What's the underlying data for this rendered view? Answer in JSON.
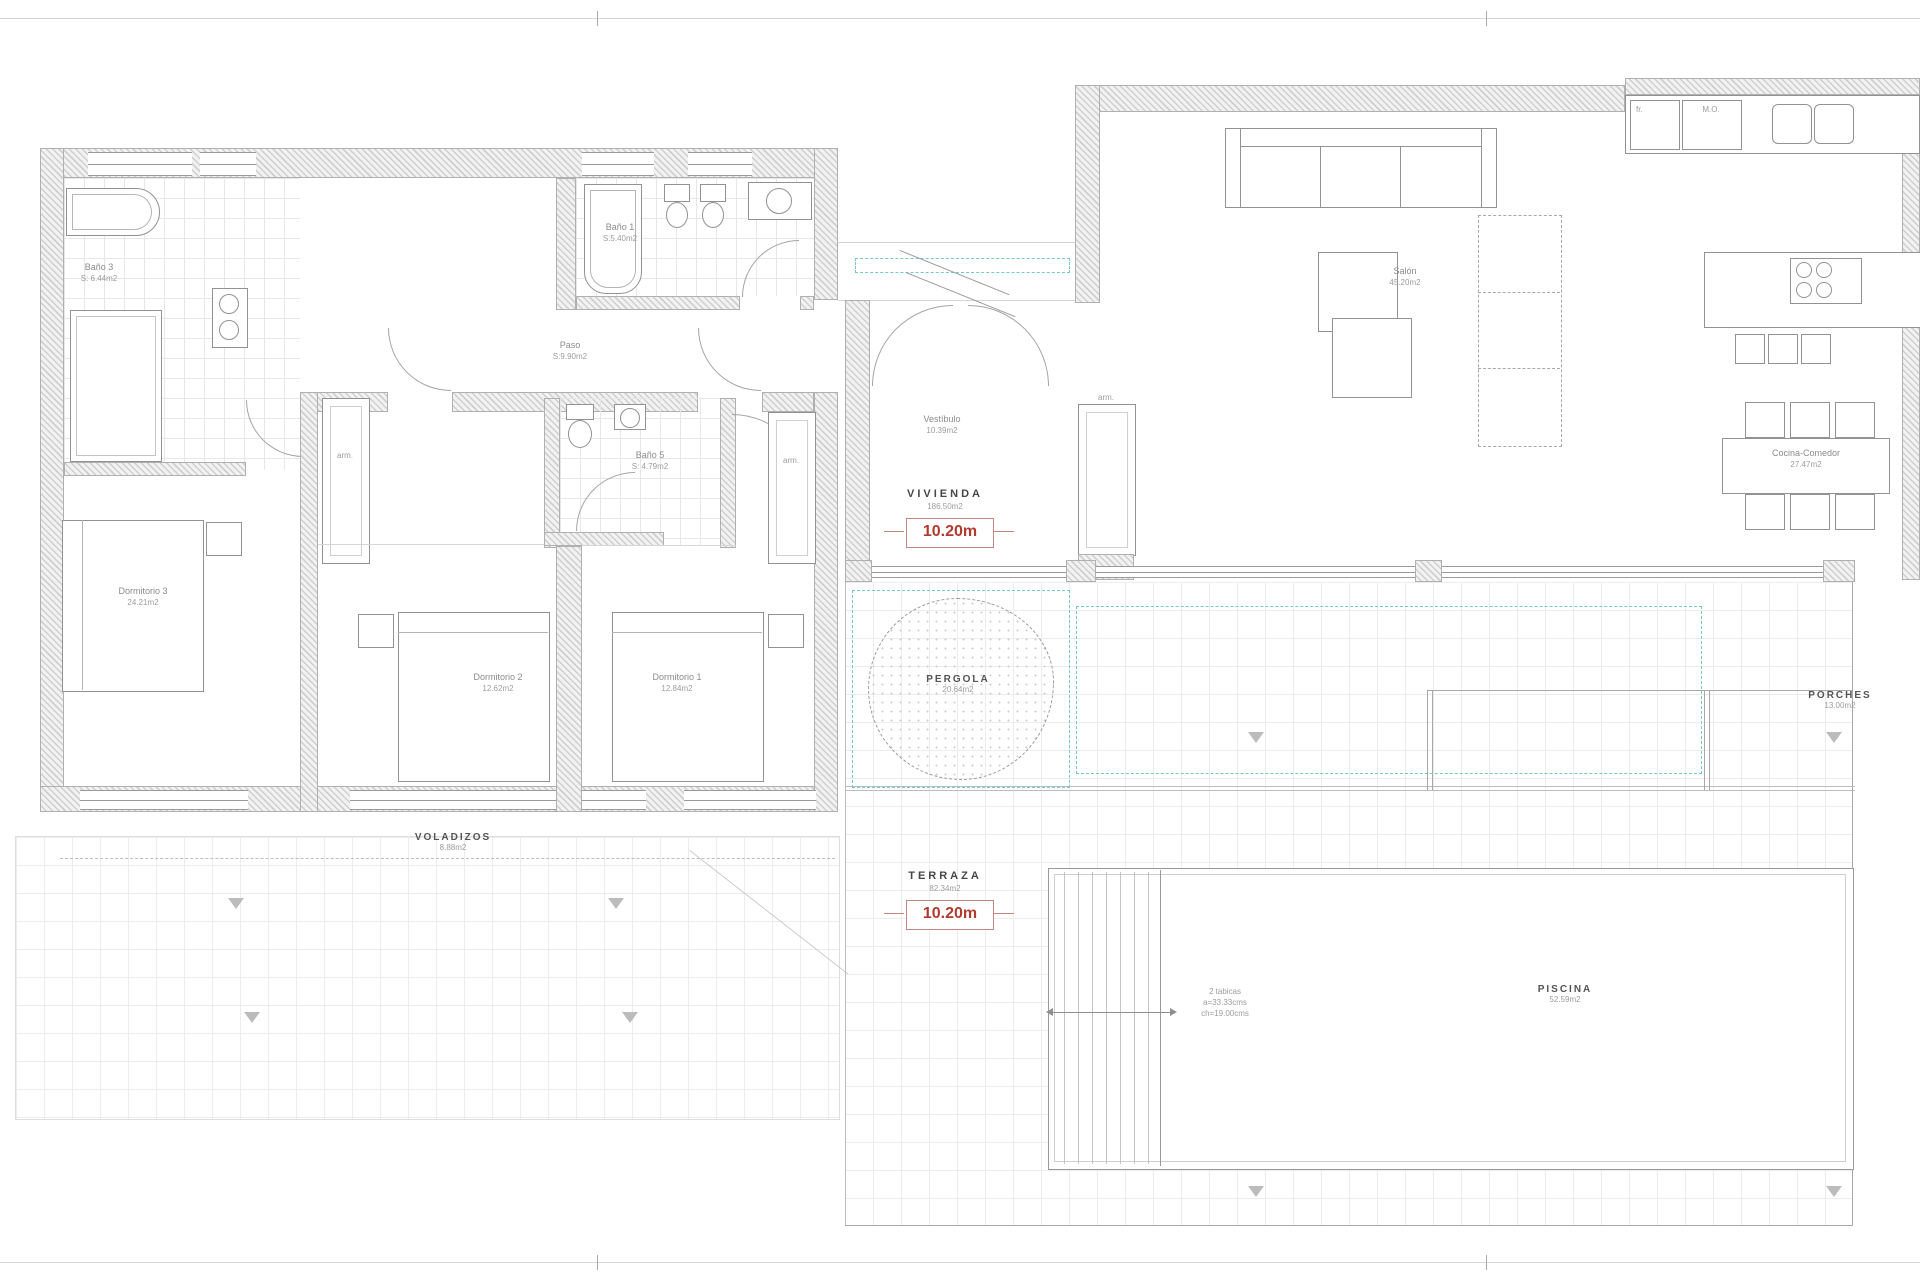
{
  "rooms": {
    "bano3": {
      "name": "Baño 3",
      "area": "S: 6.44m2"
    },
    "bano1": {
      "name": "Baño 1",
      "area": "S:5.40m2"
    },
    "bano5": {
      "name": "Baño 5",
      "area": "S: 4.79m2"
    },
    "paso": {
      "name": "Paso",
      "area": "S:9.90m2"
    },
    "vestibulo": {
      "name": "Vestíbulo",
      "area": "10.39m2"
    },
    "salon": {
      "name": "Salón",
      "area": "45.20m2"
    },
    "cocina_comedor": {
      "name": "Cocina-Comedor",
      "area": "27.47m2"
    },
    "dormitorio1": {
      "name": "Dormitorio 1",
      "area": "12.84m2"
    },
    "dormitorio2": {
      "name": "Dormitorio 2",
      "area": "12.62m2"
    },
    "dormitorio3": {
      "name": "Dormitorio 3",
      "area": "24.21m2"
    }
  },
  "zones": {
    "vivienda": {
      "name": "VIVIENDA",
      "area": "186.50m2",
      "dimension": "10.20m"
    },
    "terraza": {
      "name": "TERRAZA",
      "area": "82.34m2",
      "dimension": "10.20m"
    },
    "voladizos": {
      "name": "VOLADIZOS",
      "area": "8.88m2"
    },
    "pergola": {
      "name": "PERGOLA",
      "area": "20.64m2"
    },
    "porches": {
      "name": "PORCHES",
      "area": "13.00m2"
    },
    "piscina": {
      "name": "PISCINA",
      "area": "52.59m2"
    }
  },
  "annotations": {
    "closet_left": "arm.",
    "closet_right": "arm.",
    "closet_hall": "arm.",
    "appliance_fridge": "fr.",
    "appliance_micro": "M.O.",
    "pool_steps": {
      "line1": "2 tabicas",
      "line2": "a=33.33cms",
      "line3": "ch=19.00cms"
    }
  },
  "colors": {
    "dimension_red": "#b23a2e",
    "pergola_teal": "#79c8c8",
    "wall_grey": "#cfcfcf"
  }
}
